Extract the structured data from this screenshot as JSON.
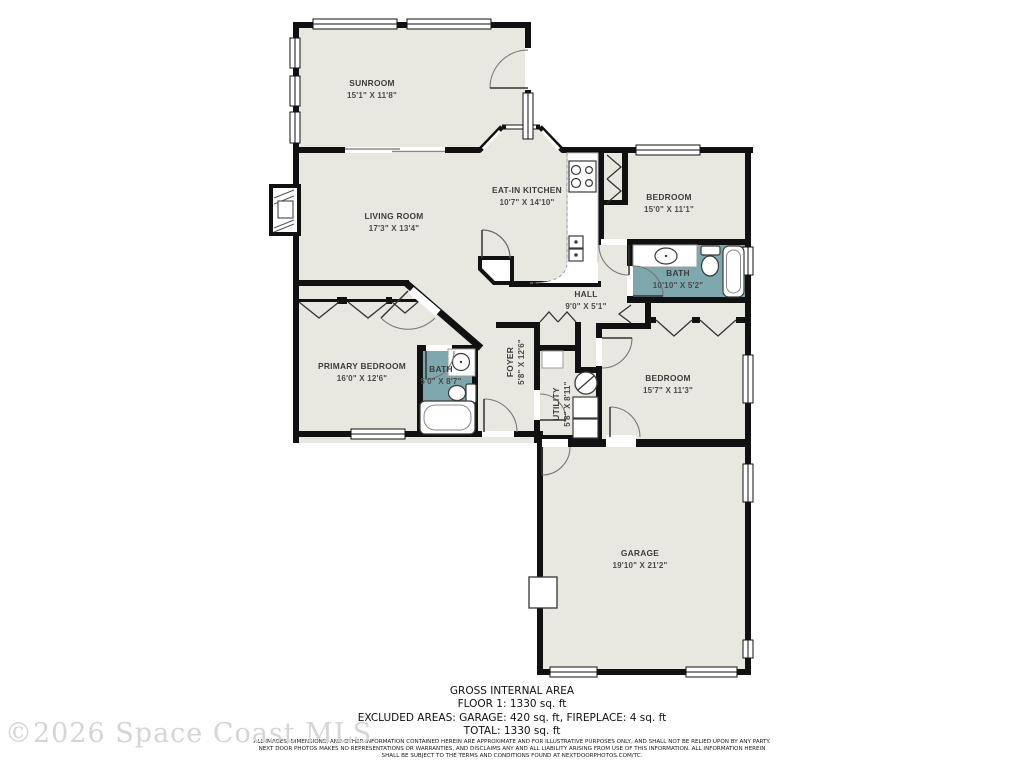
{
  "plan_title": "Residential Floor Plan",
  "colors": {
    "floor": "#e9e8e0",
    "bath_floor": "#7ea8ae",
    "wall": "#111111",
    "label": "#3d3d3d",
    "watermark_gray": "#d5d5d5"
  },
  "rooms": {
    "sunroom": {
      "name": "SUNROOM",
      "dims": "15'1\" X 11'8\""
    },
    "living": {
      "name": "LIVING ROOM",
      "dims": "17'3\" X 13'4\""
    },
    "kitchen": {
      "name": "EAT-IN KITCHEN",
      "dims": "10'7\" X 14'10\""
    },
    "bedroom1": {
      "name": "BEDROOM",
      "dims": "15'0\" X 11'1\""
    },
    "bath1": {
      "name": "BATH",
      "dims": "10'10\" X 5'2\""
    },
    "hall": {
      "name": "HALL",
      "dims": "9'0\" X 5'1\""
    },
    "primary": {
      "name": "PRIMARY BEDROOM",
      "dims": "16'0\" X 12'6\""
    },
    "bath2": {
      "name": "BATH",
      "dims": "5'0\" X 8'7\""
    },
    "foyer": {
      "name": "FOYER",
      "dims": "5'8\" X 12'6\""
    },
    "utility": {
      "name": "UTILITY",
      "dims": "5'8\" X 8'11\""
    },
    "bedroom2": {
      "name": "BEDROOM",
      "dims": "15'7\" X 11'3\""
    },
    "garage": {
      "name": "GARAGE",
      "dims": "19'10\" X 21'2\""
    }
  },
  "summary": {
    "title": "GROSS INTERNAL AREA",
    "floor": "FLOOR 1: 1330 sq. ft",
    "excluded": "EXCLUDED AREAS: GARAGE: 420 sq. ft, FIREPLACE: 4 sq. ft",
    "total": "TOTAL: 1330 sq. ft"
  },
  "disclaimer": [
    "ALL IMAGES, DIMENSIONS, AND OTHER INFORMATION CONTAINED HEREIN ARE APPROXIMATE AND FOR ILLUSTRATIVE PURPOSES ONLY, AND SHALL NOT BE RELIED UPON BY ANY PARTY.",
    "NEXT DOOR PHOTOS MAKES NO REPRESENTATIONS OR WARRANTIES, AND DISCLAIMS ANY AND ALL LIABILITY ARISING FROM USE OF THIS INFORMATION. ALL INFORMATION HEREIN",
    "SHALL BE SUBJECT TO THE TERMS AND CONDITIONS FOUND AT NEXTDOORPHOTOS.COM/TC."
  ],
  "watermark": "©2026 Space Coast MLS"
}
